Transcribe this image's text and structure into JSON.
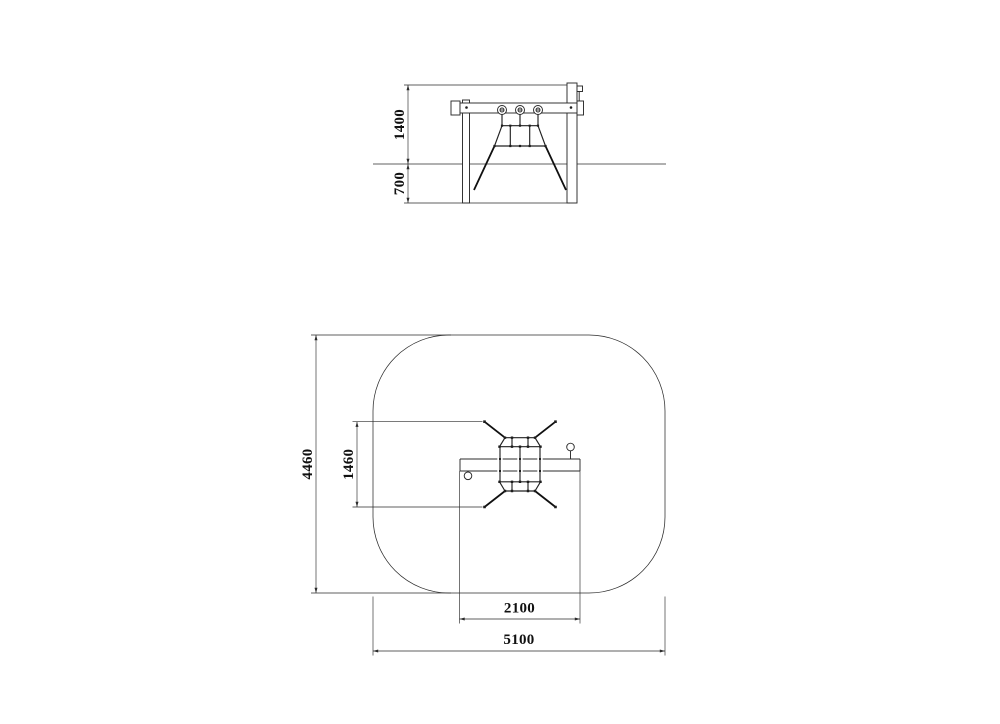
{
  "views": {
    "elevation": {
      "dims": {
        "height_above_ground_mm": "1400",
        "foundation_depth_mm": "700"
      }
    },
    "plan": {
      "dims": {
        "safety_zone_depth_mm": "4460",
        "net_anchor_span_mm": "1460",
        "frame_beam_length_mm": "2100",
        "safety_zone_width_mm": "5100"
      }
    }
  },
  "colors": {
    "background": "#ffffff",
    "line": "#2b2b2b",
    "text": "#111111"
  }
}
